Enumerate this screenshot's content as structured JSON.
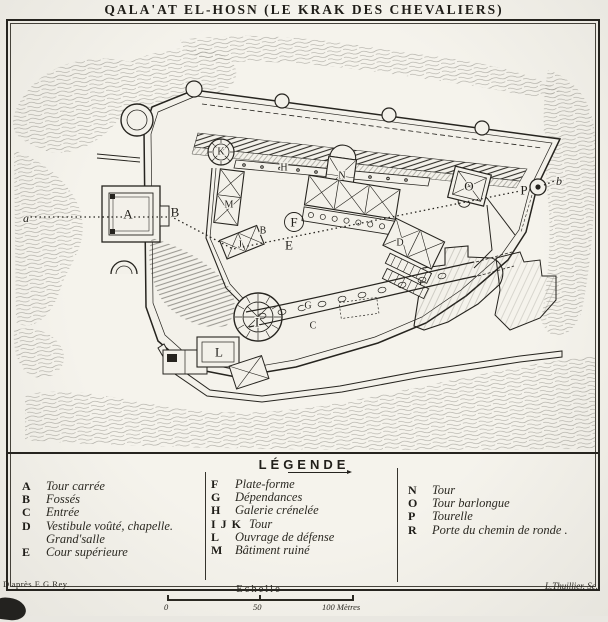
{
  "title": "QALA'AT EL-HOSN (LE KRAK DES CHEVALIERS)",
  "colors": {
    "ink": "#26241f",
    "paper": "#f3f1ea"
  },
  "legend": {
    "title": "LÉGENDE",
    "col1": [
      {
        "key": "A",
        "label": "Tour carrée"
      },
      {
        "key": "B",
        "label": "Fossés"
      },
      {
        "key": "C",
        "label": "Entrée"
      },
      {
        "key": "D",
        "label": "Vestibule voûté, chapelle. Grand'salle"
      },
      {
        "key": "E",
        "label": "Cour supérieure"
      }
    ],
    "col2": [
      {
        "key": "F",
        "label": "Plate-forme"
      },
      {
        "key": "G",
        "label": "Dépendances"
      },
      {
        "key": "H",
        "label": "Galerie crénelée"
      },
      {
        "key": "I J K",
        "label": "Tour"
      },
      {
        "key": "L",
        "label": "Ouvrage de défense"
      },
      {
        "key": "M",
        "label": "Bâtiment ruiné"
      }
    ],
    "col3": [
      {
        "key": "N",
        "label": "Tour"
      },
      {
        "key": "O",
        "label": "Tour barlongue"
      },
      {
        "key": "P",
        "label": "Tourelle"
      },
      {
        "key": "R",
        "label": "Porte du chemin de ronde ."
      }
    ]
  },
  "map": {
    "markers": [
      {
        "label": "a",
        "x": 26,
        "y": 218,
        "italic": true
      },
      {
        "label": "A",
        "x": 128,
        "y": 214
      },
      {
        "label": "B",
        "x": 175,
        "y": 212
      },
      {
        "label": "K",
        "x": 221,
        "y": 152,
        "small": true
      },
      {
        "label": "M",
        "x": 229,
        "y": 205,
        "small": true
      },
      {
        "label": "B",
        "x": 263,
        "y": 231,
        "small": true
      },
      {
        "label": "J",
        "x": 240,
        "y": 245,
        "small": true
      },
      {
        "label": "E",
        "x": 289,
        "y": 245
      },
      {
        "label": "F",
        "x": 294,
        "y": 222,
        "circled": true
      },
      {
        "label": "H",
        "x": 284,
        "y": 168,
        "small": true
      },
      {
        "label": "N",
        "x": 342,
        "y": 176,
        "small": true
      },
      {
        "label": "G",
        "x": 308,
        "y": 306,
        "small": true
      },
      {
        "label": "C",
        "x": 313,
        "y": 326,
        "small": true
      },
      {
        "label": "I",
        "x": 257,
        "y": 322
      },
      {
        "label": "L",
        "x": 219,
        "y": 352
      },
      {
        "label": "D",
        "x": 400,
        "y": 243,
        "small": true
      },
      {
        "label": "O",
        "x": 469,
        "y": 186
      },
      {
        "label": "P",
        "x": 524,
        "y": 190
      },
      {
        "label": "b",
        "x": 559,
        "y": 181,
        "italic": true
      }
    ]
  },
  "scale": {
    "label": "Echelle",
    "tick0": "0",
    "tick50": "50",
    "tick100": "100 Mètres"
  },
  "credits": {
    "left": "D'après E.G.Rey.",
    "right": "L.Thuillier. Sc."
  }
}
